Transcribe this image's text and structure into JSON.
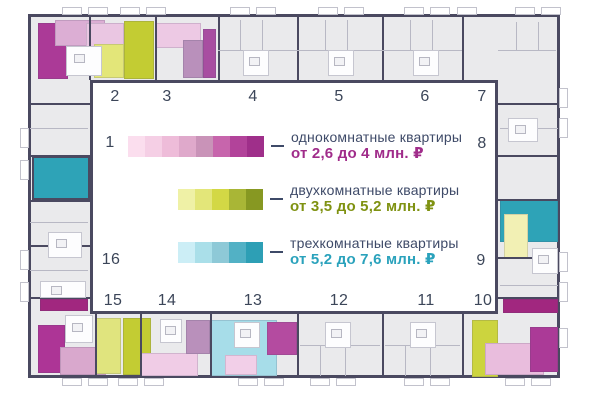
{
  "legend": {
    "label_color": "#3e4a68",
    "items": [
      {
        "id": "one-room",
        "label": "однокомнатные квартиры",
        "price": "от 2,6 до 4 млн. ₽",
        "price_color": "#a02c8a",
        "swatch": [
          "#fbdeee",
          "#f5cfe5",
          "#eebcd9",
          "#dfa9cb",
          "#c993b8",
          "#c765ac",
          "#b2439a",
          "#9f2f8a"
        ]
      },
      {
        "id": "two-room",
        "label": "двухкомнатные квартиры",
        "price": "от 3,5 до 5,2 млн. ₽",
        "price_color": "#7f9212",
        "swatch": [
          "#eff1a6",
          "#e3e679",
          "#d3d845",
          "#a9b636",
          "#879822"
        ]
      },
      {
        "id": "three-room",
        "label": "трехкомнатные квартиры",
        "price": "от 5,2 до 7,6 млн. ₽",
        "price_color": "#2aa2bc",
        "swatch": [
          "#cceef6",
          "#aadfe9",
          "#8ec9d7",
          "#52b1c5",
          "#2d9fb5"
        ]
      }
    ]
  },
  "entrances": {
    "color": "#3c4659",
    "items": [
      {
        "label": "1",
        "x": 110,
        "y": 143
      },
      {
        "label": "2",
        "x": 115,
        "y": 97
      },
      {
        "label": "3",
        "x": 167,
        "y": 97
      },
      {
        "label": "4",
        "x": 253,
        "y": 97
      },
      {
        "label": "5",
        "x": 339,
        "y": 97
      },
      {
        "label": "6",
        "x": 425,
        "y": 97
      },
      {
        "label": "7",
        "x": 482,
        "y": 97
      },
      {
        "label": "8",
        "x": 482,
        "y": 144
      },
      {
        "label": "9",
        "x": 481,
        "y": 261
      },
      {
        "label": "10",
        "x": 483,
        "y": 301
      },
      {
        "label": "11",
        "x": 426,
        "y": 301
      },
      {
        "label": "12",
        "x": 339,
        "y": 301
      },
      {
        "label": "13",
        "x": 253,
        "y": 301
      },
      {
        "label": "14",
        "x": 167,
        "y": 301
      },
      {
        "label": "15",
        "x": 113,
        "y": 301
      },
      {
        "label": "16",
        "x": 111,
        "y": 260
      }
    ]
  },
  "floorplan": {
    "wall_color": "#4a4960",
    "fill_color": "#eaeaec",
    "units": [
      {
        "type": "one-room",
        "x": 38,
        "y": 23,
        "w": 30,
        "h": 56,
        "c": "#ab3a97"
      },
      {
        "type": "one-room",
        "x": 55,
        "y": 20,
        "w": 50,
        "h": 26,
        "c": "#dcaed4"
      },
      {
        "type": "one-room",
        "x": 86,
        "y": 23,
        "w": 38,
        "h": 31,
        "c": "#eac6e2"
      },
      {
        "type": "two-room",
        "x": 94,
        "y": 44,
        "w": 30,
        "h": 34,
        "c": "#e3e679"
      },
      {
        "type": "two-room",
        "x": 124,
        "y": 21,
        "w": 30,
        "h": 58,
        "c": "#c3cc33"
      },
      {
        "type": "one-room",
        "x": 156,
        "y": 23,
        "w": 45,
        "h": 25,
        "c": "#edc9e4"
      },
      {
        "type": "one-room",
        "x": 183,
        "y": 40,
        "w": 20,
        "h": 38,
        "c": "#b990bb"
      },
      {
        "type": "one-room",
        "x": 203,
        "y": 29,
        "w": 13,
        "h": 49,
        "c": "#a84da1"
      },
      {
        "type": "three-room",
        "x": 32,
        "y": 156,
        "w": 58,
        "h": 44,
        "c": "#2ea3b7",
        "edge": true
      },
      {
        "type": "one-room",
        "x": 40,
        "y": 299,
        "w": 48,
        "h": 12,
        "c": "#a1277f"
      },
      {
        "type": "one-room",
        "x": 38,
        "y": 325,
        "w": 27,
        "h": 48,
        "c": "#ad3596"
      },
      {
        "type": "one-room",
        "x": 60,
        "y": 347,
        "w": 46,
        "h": 28,
        "c": "#d9a8cd"
      },
      {
        "type": "two-room",
        "x": 95,
        "y": 318,
        "w": 26,
        "h": 56,
        "c": "#e0e47e"
      },
      {
        "type": "two-room",
        "x": 123,
        "y": 318,
        "w": 28,
        "h": 57,
        "c": "#c3cc33"
      },
      {
        "type": "one-room",
        "x": 141,
        "y": 353,
        "w": 57,
        "h": 23,
        "c": "#f0cce6"
      },
      {
        "type": "one-room",
        "x": 186,
        "y": 320,
        "w": 24,
        "h": 34,
        "c": "#b990bb"
      },
      {
        "type": "three-room",
        "x": 210,
        "y": 320,
        "w": 67,
        "h": 56,
        "c": "#a7dde9"
      },
      {
        "type": "one-room",
        "x": 225,
        "y": 355,
        "w": 32,
        "h": 20,
        "c": "#f2cfe8"
      },
      {
        "type": "one-room",
        "x": 267,
        "y": 322,
        "w": 30,
        "h": 33,
        "c": "#b44ba0"
      },
      {
        "type": "two-room",
        "x": 472,
        "y": 320,
        "w": 26,
        "h": 57,
        "c": "#ccd43e"
      },
      {
        "type": "one-room",
        "x": 485,
        "y": 343,
        "w": 59,
        "h": 32,
        "c": "#e9bddd"
      },
      {
        "type": "one-room",
        "x": 530,
        "y": 327,
        "w": 28,
        "h": 45,
        "c": "#ab3a97"
      },
      {
        "type": "one-room",
        "x": 503,
        "y": 299,
        "w": 55,
        "h": 14,
        "c": "#a1277f"
      },
      {
        "type": "three-room",
        "x": 500,
        "y": 199,
        "w": 58,
        "h": 43,
        "c": "#2ea3b7"
      },
      {
        "type": "two-room",
        "x": 504,
        "y": 214,
        "w": 24,
        "h": 44,
        "c": "#f2f0b4"
      }
    ]
  }
}
